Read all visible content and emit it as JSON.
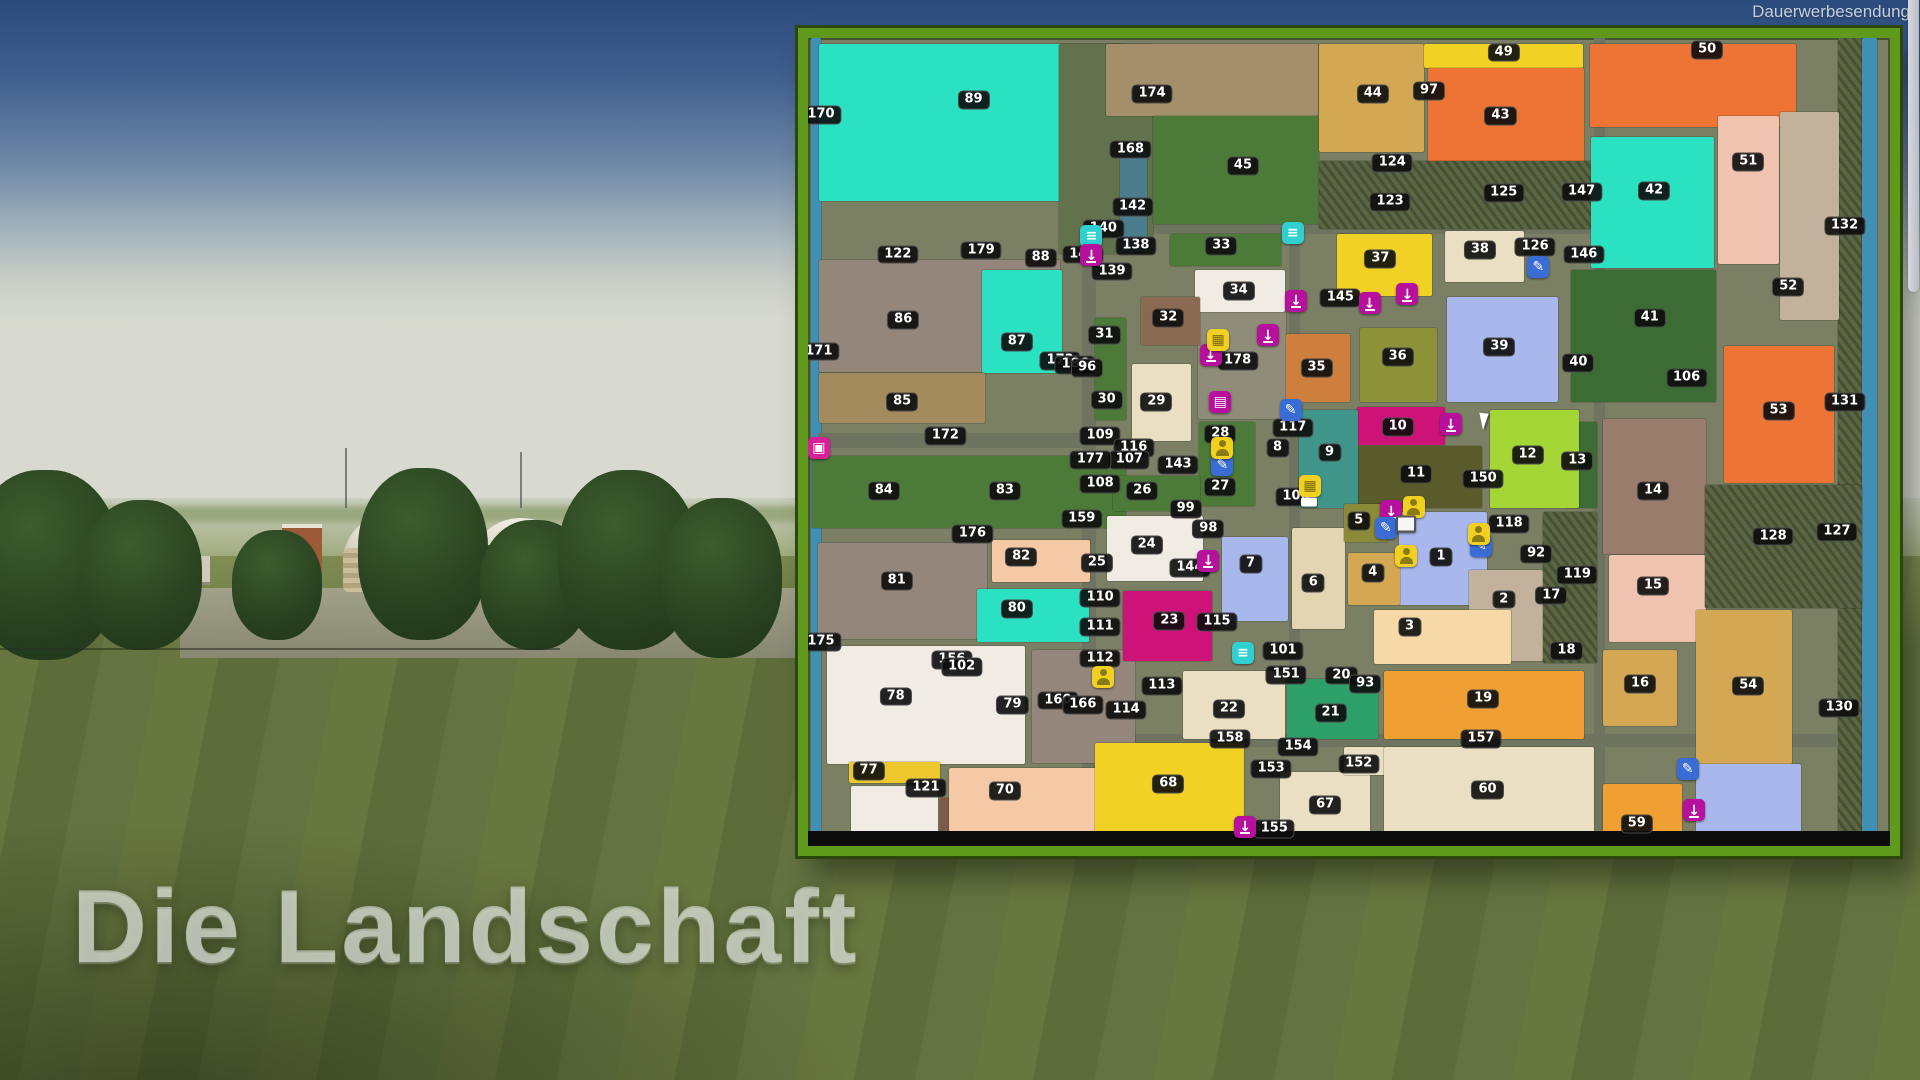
{
  "meta": {
    "watermark": "Dauerwerbesendung",
    "caption": "Die Landschaft"
  },
  "map": {
    "palette": {
      "tq": "#2ae2c1",
      "grn": "#4b7a39",
      "grn2": "#3c6c33",
      "frs": "#5c6544",
      "olv36": "#8c9237",
      "olv5": "#8a8a39",
      "olv11": "#5a5b2b",
      "yel": "#f1d224",
      "yelD": "#ecc72e",
      "lim": "#a4d636",
      "org": "#ed7435",
      "orgL": "#f0a032",
      "orgM": "#cf7f3d",
      "tan": "#d4a852",
      "kha": "#a38b5e",
      "crm": "#eadfc2",
      "crmD": "#e3d4b2",
      "wht": "#f1ece3",
      "pch": "#f6c9a6",
      "pnk": "#f0c2b0",
      "mag": "#ce1378",
      "brn": "#8a6a50",
      "bgr": "#94867a",
      "b121": "#7c5a49",
      "mau": "#9a7c6c",
      "per": "#a8b7ec",
      "tea": "#3f958a",
      "g21": "#2da06a",
      "pal3": "#f6d9a6",
      "gtn": "#c2b29b",
      "wat": "#4090b6",
      "w142": "#4b7d8f",
      "road": "#6f7460",
      "farm": "#8f8c79",
      "blk": "#0c0c0c",
      "band174": "#a3906b",
      "band89": "#61724c"
    },
    "blocks": [
      [
        0.3,
        0,
        0.9,
        100,
        "wat"
      ],
      [
        95.2,
        0,
        2.2,
        100,
        "frs"
      ],
      [
        97.4,
        0,
        1.4,
        100,
        "wat"
      ],
      [
        25.3,
        22.5,
        1.3,
        75.7,
        "road"
      ],
      [
        44.5,
        23.0,
        1.0,
        64.5,
        "road"
      ],
      [
        72.6,
        0,
        1.1,
        98,
        "road"
      ],
      [
        0.9,
        48.9,
        24.4,
        1.9,
        "road"
      ],
      [
        25.3,
        86.2,
        69.9,
        1.5,
        "road"
      ],
      [
        25.3,
        23.0,
        47.3,
        1.2,
        "road"
      ],
      [
        36.0,
        33.9,
        8.2,
        13.3,
        "farm"
      ],
      [
        1.0,
        0.7,
        28.0,
        19.5,
        "tq"
      ],
      [
        23.2,
        0.7,
        8.7,
        26.0,
        "band89"
      ],
      [
        27.5,
        0.7,
        19.6,
        9.0,
        "band174"
      ],
      [
        28.8,
        14.0,
        2.5,
        12.5,
        "w142"
      ],
      [
        31.9,
        9.7,
        15.3,
        13.3,
        "grn"
      ],
      [
        47.2,
        0.7,
        9.7,
        13.4,
        "tan"
      ],
      [
        56.9,
        0.7,
        14.7,
        3.0,
        "yel"
      ],
      [
        57.3,
        3.7,
        14.4,
        11.7,
        "org"
      ],
      [
        72.3,
        0.7,
        19.0,
        10.3,
        "org"
      ],
      [
        47.2,
        15.2,
        25.4,
        8.5,
        "frs"
      ],
      [
        72.4,
        12.2,
        11.3,
        16.3,
        "tq"
      ],
      [
        84.1,
        9.6,
        5.6,
        18.4,
        "pnk"
      ],
      [
        89.8,
        9.1,
        5.5,
        25.8,
        "gtn"
      ],
      [
        33.5,
        24.2,
        10.2,
        4.0,
        "grn"
      ],
      [
        48.9,
        24.2,
        8.8,
        7.7,
        "yel"
      ],
      [
        58.9,
        23.9,
        7.3,
        6.3,
        "crm"
      ],
      [
        59.1,
        32.1,
        10.2,
        13.0,
        "per"
      ],
      [
        51.0,
        35.9,
        7.1,
        9.2,
        "olv36"
      ],
      [
        44.2,
        36.6,
        5.9,
        8.5,
        "orgM"
      ],
      [
        35.8,
        28.7,
        8.3,
        5.2,
        "wht"
      ],
      [
        30.8,
        32.1,
        5.4,
        5.9,
        "brn"
      ],
      [
        29.9,
        40.4,
        5.5,
        9.5,
        "crm"
      ],
      [
        26.5,
        34.7,
        2.9,
        12.6,
        "grn"
      ],
      [
        1.0,
        27.5,
        22.3,
        13.9,
        "bgr"
      ],
      [
        16.1,
        28.7,
        7.4,
        12.7,
        "tq"
      ],
      [
        1.0,
        41.5,
        15.4,
        6.2,
        "kha"
      ],
      [
        0.4,
        51.7,
        29.0,
        8.9,
        "grn"
      ],
      [
        0.9,
        62.5,
        15.6,
        11.9,
        "bgr"
      ],
      [
        17.0,
        62.1,
        9.1,
        5.2,
        "pch"
      ],
      [
        15.6,
        68.2,
        10.4,
        6.5,
        "tq"
      ],
      [
        1.8,
        75.3,
        18.3,
        14.5,
        "wht"
      ],
      [
        20.7,
        75.7,
        9.5,
        14.0,
        "bgr"
      ],
      [
        3.8,
        89.6,
        8.4,
        2.6,
        "yelD"
      ],
      [
        4.0,
        92.6,
        8.0,
        6.2,
        "wht"
      ],
      [
        12.2,
        94.1,
        8.5,
        4.7,
        "b121"
      ],
      [
        13.0,
        90.3,
        17.2,
        8.2,
        "pch"
      ],
      [
        27.6,
        59.2,
        8.9,
        8.0,
        "wht"
      ],
      [
        29.1,
        68.5,
        8.2,
        8.6,
        "mag"
      ],
      [
        36.1,
        47.5,
        5.2,
        10.4,
        "grn"
      ],
      [
        28.2,
        54.2,
        8.0,
        4.4,
        "grn"
      ],
      [
        70.5,
        28.7,
        13.4,
        16.4,
        "grn2"
      ],
      [
        70.1,
        47.5,
        2.8,
        10.7,
        "grn2"
      ],
      [
        63.0,
        46.0,
        8.3,
        12.2,
        "lim"
      ],
      [
        50.7,
        45.7,
        8.2,
        4.7,
        "mag"
      ],
      [
        50.7,
        50.5,
        11.6,
        7.7,
        "olv11"
      ],
      [
        45.4,
        46.0,
        5.4,
        12.2,
        "tea"
      ],
      [
        54.6,
        58.7,
        8.2,
        11.5,
        "per"
      ],
      [
        61.1,
        65.8,
        6.8,
        11.3,
        "gtn"
      ],
      [
        52.3,
        70.8,
        12.7,
        6.7,
        "pal3"
      ],
      [
        38.3,
        61.8,
        6.1,
        10.4,
        "per"
      ],
      [
        44.7,
        60.7,
        4.9,
        12.5,
        "crmD"
      ],
      [
        49.9,
        63.7,
        4.8,
        6.5,
        "tan"
      ],
      [
        49.5,
        57.7,
        4.0,
        4.7,
        "olv5"
      ],
      [
        67.9,
        58.7,
        5.0,
        18.6,
        "frs"
      ],
      [
        84.7,
        38.1,
        10.1,
        17.0,
        "org"
      ],
      [
        73.5,
        47.2,
        9.5,
        16.7,
        "mau"
      ],
      [
        74.0,
        64.0,
        9.0,
        10.7,
        "pnk"
      ],
      [
        73.5,
        75.7,
        6.8,
        9.5,
        "tan"
      ],
      [
        82.1,
        70.8,
        8.8,
        19.0,
        "tan"
      ],
      [
        82.9,
        55.3,
        14.5,
        15.3,
        "frs"
      ],
      [
        34.7,
        78.3,
        9.4,
        8.5,
        "crm"
      ],
      [
        44.3,
        79.3,
        8.4,
        7.4,
        "g21"
      ],
      [
        53.2,
        78.3,
        18.5,
        8.5,
        "orgL"
      ],
      [
        26.5,
        87.3,
        13.8,
        11.2,
        "yel"
      ],
      [
        43.6,
        90.8,
        8.3,
        8.0,
        "crm"
      ],
      [
        49.5,
        87.8,
        3.8,
        3.4,
        "crm"
      ],
      [
        53.2,
        87.8,
        19.4,
        10.7,
        "crm"
      ],
      [
        73.5,
        92.3,
        7.3,
        6.2,
        "orgL"
      ],
      [
        82.1,
        89.9,
        9.7,
        8.6,
        "per"
      ],
      [
        0,
        98.2,
        100,
        1.8,
        "blk"
      ]
    ],
    "labels": [
      [
        "170",
        1.2,
        9.5
      ],
      [
        "89",
        15.3,
        7.7
      ],
      [
        "174",
        31.8,
        6.9
      ],
      [
        "168",
        29.8,
        13.8
      ],
      [
        "45",
        40.2,
        15.8
      ],
      [
        "142",
        30.0,
        20.9
      ],
      [
        "140",
        27.3,
        23.6
      ],
      [
        "141",
        25.4,
        26.8
      ],
      [
        "139",
        28.1,
        28.9
      ],
      [
        "138",
        30.3,
        25.7
      ],
      [
        "122",
        8.3,
        26.8
      ],
      [
        "179",
        16.0,
        26.3
      ],
      [
        "88",
        21.5,
        27.2
      ],
      [
        "33",
        38.2,
        25.7
      ],
      [
        "34",
        39.8,
        31.3
      ],
      [
        "37",
        52.9,
        27.4
      ],
      [
        "38",
        62.1,
        26.2
      ],
      [
        "126",
        67.2,
        25.9
      ],
      [
        "44",
        52.2,
        6.9
      ],
      [
        "97",
        57.4,
        6.6
      ],
      [
        "43",
        64.0,
        9.6
      ],
      [
        "49",
        64.3,
        1.8
      ],
      [
        "50",
        83.1,
        1.5
      ],
      [
        "124",
        54.0,
        15.5
      ],
      [
        "123",
        53.8,
        20.3
      ],
      [
        "125",
        64.3,
        19.2
      ],
      [
        "42",
        78.2,
        18.9
      ],
      [
        "51",
        86.9,
        15.3
      ],
      [
        "147",
        71.5,
        19.1
      ],
      [
        "146",
        71.7,
        26.8
      ],
      [
        "52",
        90.6,
        30.8
      ],
      [
        "132",
        95.8,
        23.3
      ],
      [
        "86",
        8.8,
        34.9
      ],
      [
        "87",
        19.3,
        37.6
      ],
      [
        "171",
        1.0,
        38.8
      ],
      [
        "173",
        23.3,
        40.0
      ],
      [
        "186",
        24.7,
        40.5
      ],
      [
        "96",
        25.8,
        40.9
      ],
      [
        "31",
        27.4,
        36.8
      ],
      [
        "32",
        33.3,
        34.7
      ],
      [
        "30",
        27.6,
        44.8
      ],
      [
        "29",
        32.2,
        45.0
      ],
      [
        "178",
        39.7,
        40.0
      ],
      [
        "35",
        47.0,
        40.9
      ],
      [
        "36",
        54.5,
        39.5
      ],
      [
        "39",
        63.9,
        38.2
      ],
      [
        "145",
        49.2,
        32.2
      ],
      [
        "40",
        71.2,
        40.2
      ],
      [
        "41",
        77.8,
        34.6
      ],
      [
        "106",
        81.2,
        42.1
      ],
      [
        "53",
        89.7,
        46.2
      ],
      [
        "131",
        95.8,
        45.1
      ],
      [
        "85",
        8.7,
        45.1
      ],
      [
        "172",
        12.7,
        49.3
      ],
      [
        "109",
        27.0,
        49.3
      ],
      [
        "116",
        30.1,
        50.7
      ],
      [
        "107",
        29.7,
        52.2
      ],
      [
        "177",
        26.1,
        52.2
      ],
      [
        "108",
        27.0,
        55.2
      ],
      [
        "26",
        30.9,
        56.1
      ],
      [
        "143",
        34.2,
        52.9
      ],
      [
        "27",
        38.1,
        55.6
      ],
      [
        "28",
        38.1,
        49.0
      ],
      [
        "8",
        43.4,
        50.8
      ],
      [
        "117",
        44.8,
        48.3
      ],
      [
        "9",
        48.2,
        51.3
      ],
      [
        "10",
        54.5,
        48.1
      ],
      [
        "11",
        56.2,
        54.0
      ],
      [
        "12",
        66.5,
        51.6
      ],
      [
        "150",
        62.4,
        54.6
      ],
      [
        "13",
        71.1,
        52.3
      ],
      [
        "14",
        78.1,
        56.1
      ],
      [
        "128",
        89.2,
        61.7
      ],
      [
        "127",
        95.1,
        61.1
      ],
      [
        "84",
        7.0,
        56.1
      ],
      [
        "83",
        18.2,
        56.1
      ],
      [
        "176",
        15.2,
        61.4
      ],
      [
        "82",
        19.7,
        64.2
      ],
      [
        "81",
        8.2,
        67.2
      ],
      [
        "80",
        19.3,
        70.7
      ],
      [
        "175",
        1.2,
        74.7
      ],
      [
        "159",
        25.3,
        59.5
      ],
      [
        "24",
        31.3,
        62.7
      ],
      [
        "25",
        26.7,
        65.0
      ],
      [
        "144",
        35.3,
        65.6
      ],
      [
        "98",
        37.0,
        60.8
      ],
      [
        "99",
        34.9,
        58.3
      ],
      [
        "23",
        33.4,
        72.2
      ],
      [
        "115",
        37.8,
        72.3
      ],
      [
        "110",
        27.0,
        69.3
      ],
      [
        "111",
        27.0,
        72.9
      ],
      [
        "112",
        27.0,
        76.8
      ],
      [
        "113",
        32.7,
        80.2
      ],
      [
        "114",
        29.4,
        83.2
      ],
      [
        "156",
        13.3,
        77.0
      ],
      [
        "102",
        14.2,
        77.9
      ],
      [
        "160",
        23.1,
        82.0
      ],
      [
        "166",
        25.4,
        82.6
      ],
      [
        "7",
        40.9,
        65.1
      ],
      [
        "6",
        46.7,
        67.5
      ],
      [
        "5",
        50.9,
        59.8
      ],
      [
        "4",
        52.2,
        66.2
      ],
      [
        "1",
        58.5,
        64.2
      ],
      [
        "3",
        55.6,
        72.9
      ],
      [
        "2",
        64.3,
        69.5
      ],
      [
        "118",
        64.8,
        60.2
      ],
      [
        "92",
        67.3,
        63.9
      ],
      [
        "17",
        68.7,
        69.0
      ],
      [
        "18",
        70.1,
        75.9
      ],
      [
        "119",
        71.1,
        66.5
      ],
      [
        "15",
        78.1,
        67.8
      ],
      [
        "16",
        76.9,
        80.0
      ],
      [
        "54",
        86.9,
        80.2
      ],
      [
        "130",
        95.3,
        82.9
      ],
      [
        "100",
        45.1,
        56.8
      ],
      [
        "101",
        43.9,
        75.9
      ],
      [
        "151",
        44.2,
        78.8
      ],
      [
        "20",
        49.3,
        78.9
      ],
      [
        "93",
        51.5,
        80.0
      ],
      [
        "22",
        38.9,
        83.0
      ],
      [
        "21",
        48.3,
        83.5
      ],
      [
        "19",
        62.4,
        81.8
      ],
      [
        "158",
        39.0,
        86.8
      ],
      [
        "154",
        45.3,
        87.7
      ],
      [
        "153",
        42.8,
        90.5
      ],
      [
        "152",
        50.9,
        89.9
      ],
      [
        "68",
        33.3,
        92.3
      ],
      [
        "67",
        47.8,
        94.9
      ],
      [
        "155",
        43.1,
        97.9
      ],
      [
        "60",
        62.8,
        93.1
      ],
      [
        "157",
        62.2,
        86.8
      ],
      [
        "59",
        76.6,
        97.3
      ],
      [
        "77",
        5.6,
        90.7
      ],
      [
        "121",
        10.9,
        92.8
      ],
      [
        "70",
        18.2,
        93.2
      ],
      [
        "78",
        8.1,
        81.5
      ],
      [
        "79",
        18.9,
        82.6
      ]
    ],
    "icons": [
      [
        "menu",
        26.2,
        24.5
      ],
      [
        "menu",
        44.8,
        24.1
      ],
      [
        "menu",
        40.2,
        76.1
      ],
      [
        "sell",
        26.2,
        26.9
      ],
      [
        "sell",
        45.1,
        32.5
      ],
      [
        "sell",
        51.9,
        32.8
      ],
      [
        "sell",
        55.4,
        31.7
      ],
      [
        "sell",
        37.2,
        39.2
      ],
      [
        "sell",
        42.5,
        36.8
      ],
      [
        "sell",
        37.0,
        64.7
      ],
      [
        "sell",
        53.9,
        58.6
      ],
      [
        "sell",
        59.4,
        47.8
      ],
      [
        "sell",
        40.4,
        97.6
      ],
      [
        "sell",
        81.9,
        95.6
      ],
      [
        "net",
        38.1,
        45.0
      ],
      [
        "board",
        67.5,
        28.4
      ],
      [
        "board",
        44.6,
        46.0
      ],
      [
        "board",
        38.3,
        52.9
      ],
      [
        "board",
        53.4,
        60.6
      ],
      [
        "board",
        62.2,
        62.9
      ],
      [
        "board",
        81.3,
        90.5
      ],
      [
        "shop",
        37.9,
        37.4
      ],
      [
        "shop",
        46.4,
        55.5
      ],
      [
        "person",
        56.0,
        58.0
      ],
      [
        "person",
        62.0,
        61.4
      ],
      [
        "person",
        55.3,
        64.1
      ],
      [
        "person",
        27.3,
        79.1
      ],
      [
        "person",
        38.3,
        50.7
      ],
      [
        "prod",
        1.0,
        50.8
      ],
      [
        "monitor",
        55.3,
        60.2
      ],
      [
        "truck",
        46.3,
        57.4
      ]
    ],
    "cursor": {
      "x": 62.2,
      "y": 46.2
    },
    "icon_glyphs": {
      "sell": "↓",
      "menu": "≡",
      "board": "✎",
      "shop": "▦",
      "net": "▤",
      "prod": "▣"
    }
  }
}
